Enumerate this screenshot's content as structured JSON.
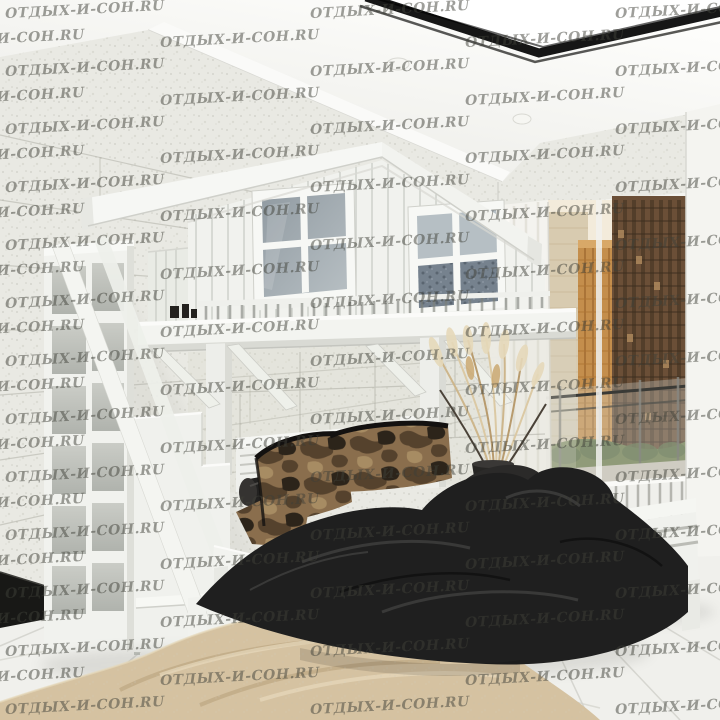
{
  "watermark": {
    "text": "ОТДЫХ-И-СОН.RU",
    "rows": 25,
    "row_step": 29,
    "top": 2,
    "even_x": [
      5,
      310,
      615
    ],
    "odd_x": [
      -75,
      160,
      465
    ],
    "rotate_deg": -3,
    "font_size_px": 14,
    "color": "#3f4038",
    "opacity": 0.5
  },
  "palette": {
    "wm": "#3f4038",
    "wall": "#e9e9e3",
    "wall-line": "#b1b1a8",
    "white-wood": "#f3f4f0",
    "duvet": "#1f1f1f",
    "camo-base": "#8a6e4d",
    "camo-dark": "#55422d",
    "camo-black": "#2c241a",
    "camo-light": "#a78c63",
    "rug": "#d5c2a1",
    "rug-shadow": "#b49c76",
    "rug-light": "#e7d9bc",
    "sky": "#f3ebdb",
    "city-brown": "#6b4f37",
    "city-orange": "#c48e4c",
    "trim": "#161616",
    "curtain": "#f4f3ee",
    "bedding": "#76828e",
    "floor": "#f0f0ec",
    "floor-line": "#d1d1cb"
  }
}
